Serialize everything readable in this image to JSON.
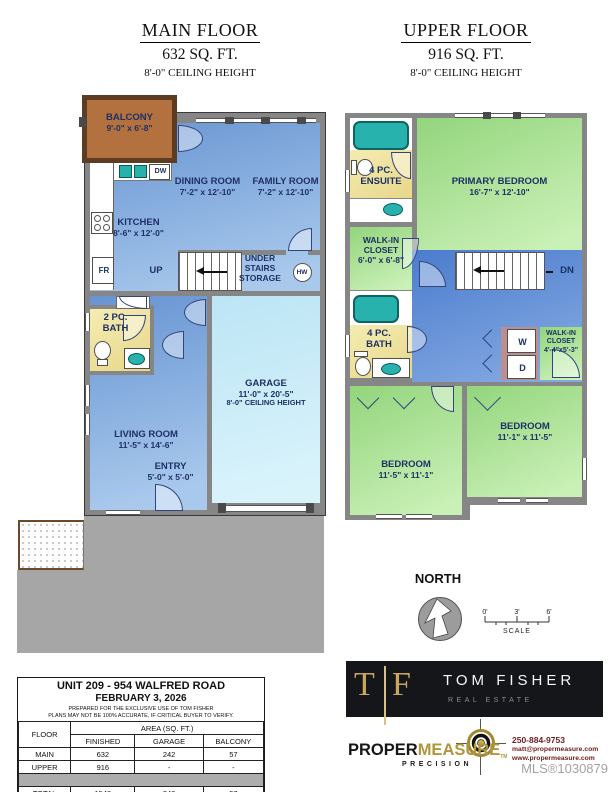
{
  "titles": {
    "main": {
      "name": "MAIN FLOOR",
      "area": "632 SQ. FT.",
      "ceiling": "8'-0\" CEILING HEIGHT"
    },
    "upper": {
      "name": "UPPER FLOOR",
      "area": "916 SQ. FT.",
      "ceiling": "8'-0\" CEILING HEIGHT"
    }
  },
  "main_floor": {
    "balcony": {
      "name": "BALCONY",
      "dims": "9'-0\" x 6'-8\""
    },
    "dining": {
      "name": "DINING ROOM",
      "dims": "7'-2\" x 12'-10\""
    },
    "family": {
      "name": "FAMILY ROOM",
      "dims": "7'-2\" x 12'-10\""
    },
    "kitchen": {
      "name": "KITCHEN",
      "dims": "8'-6\" x 12'-0\""
    },
    "bath": {
      "line1": "2 PC.",
      "line2": "BATH"
    },
    "living": {
      "name": "LIVING ROOM",
      "dims": "11'-5\" x 14'-6\""
    },
    "entry": {
      "name": "ENTRY",
      "dims": "5'-0\" x 5'-0\""
    },
    "garage": {
      "name": "GARAGE",
      "dims": "11'-0\" x 20'-5\"",
      "ceiling": "8'-0\" CEILING HEIGHT"
    },
    "up": "UP",
    "under1": "UNDER",
    "under2": "STAIRS",
    "under3": "STORAGE",
    "hw": "HW",
    "fr": "FR",
    "dw": "DW"
  },
  "upper_floor": {
    "ensuite": {
      "line1": "4 PC.",
      "line2": "ENSUITE"
    },
    "primary": {
      "name": "PRIMARY BEDROOM",
      "dims": "16'-7\" x 12'-10\""
    },
    "wic1": {
      "line1": "WALK-IN",
      "line2": "CLOSET",
      "dims": "6'-0\" x 6'-8\""
    },
    "bath": {
      "line1": "4 PC.",
      "line2": "BATH"
    },
    "wic2": {
      "line1": "WALK-IN",
      "line2": "CLOSET",
      "dims": "4'-4\"x5'-3\""
    },
    "bedroom_left": {
      "name": "BEDROOM",
      "dims": "11'-5\" x 11'-1\""
    },
    "bedroom_right": {
      "name": "BEDROOM",
      "dims": "11'-1\" x 11'-5\""
    },
    "dn": "DN",
    "washer": "W",
    "dryer": "D"
  },
  "compass": {
    "label": "NORTH"
  },
  "scale_bar": {
    "t0": "0'",
    "t3": "3'",
    "t6": "6'",
    "label": "SCALE"
  },
  "info_table": {
    "title": "UNIT 209 - 954 WALFRED ROAD",
    "date": "FEBRUARY 3, 2026",
    "note1": "PREPARED FOR THE EXCLUSIVE USE OF TOM FISHER",
    "note2": "PLANS MAY NOT BE 100% ACCURATE, IF CRITICAL BUYER TO VERIFY.",
    "col_floor": "FLOOR",
    "col_area": "AREA (SQ. FT.)",
    "col_finished": "FINISHED",
    "col_garage": "GARAGE",
    "col_balcony": "BALCONY",
    "rows": [
      {
        "floor": "MAIN",
        "finished": "632",
        "garage": "242",
        "balcony": "57"
      },
      {
        "floor": "UPPER",
        "finished": "916",
        "garage": "-",
        "balcony": "-"
      }
    ],
    "total": {
      "floor": "TOTAL",
      "finished": "1548",
      "garage": "242",
      "balcony": "57"
    }
  },
  "branding": {
    "tf_t": "T",
    "tf_f": "F",
    "name": "TOM FISHER",
    "tagline": "REAL ESTATE",
    "pm_proper": "PROPER",
    "pm_measure": "MEASURE",
    "pm_tm": "TM",
    "pm_precision": "PRECISION",
    "phone": "250-884-9753",
    "email": "matt@propermeasure.com",
    "web": "www.propermeasure.com",
    "mls": "MLS®1030879"
  },
  "colors": {
    "wall_gray": "#868686",
    "room_blue": "#6794d2",
    "hall_blue": "#4b7ccd",
    "garage_cyan": "#bce5f5",
    "bedroom_green": "#93d57c",
    "bath_yellow": "#f2e8a8",
    "fixture_teal": "#28b2ae",
    "balcony_brown": "#b3713f",
    "brand_gold": "#c9a55e",
    "contact_maroon": "#6f2020"
  }
}
